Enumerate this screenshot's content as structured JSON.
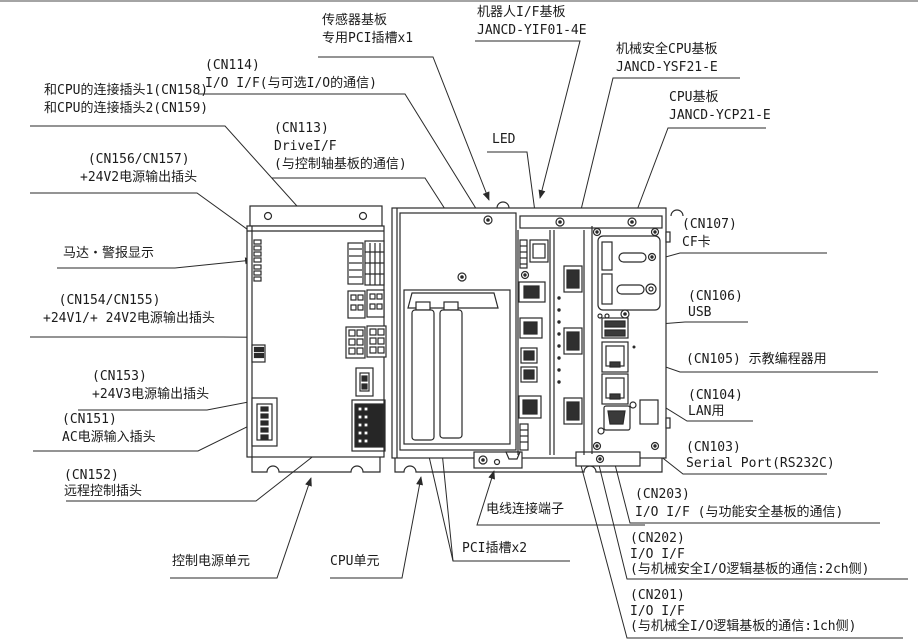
{
  "page": {
    "type": "hardware-connection-diagram"
  },
  "colors": {
    "line": "#2a2a2a",
    "text": "#1b1b1b",
    "background": "#ffffff"
  },
  "labels": {
    "sensor_pci_slot": "传感器基板\n专用PCI插槽x1",
    "robot_if_board": "机器人I/F基板\nJANCD-YIF01-4E",
    "safety_cpu_board": "机械安全CPU基板\nJANCD-YSF21-E",
    "cpu_board": "CPU基板\nJANCD-YCP21-E",
    "cn114": "(CN114)\nI/O I/F(与可选I/O的通信)",
    "led": "LED",
    "cn113": "(CN113)\nDriveI/F\n(与控制轴基板的通信)",
    "cn158_159": "和CPU的连接插头1(CN158)\n和CPU的连接插头2(CN159)",
    "cn156_157": " (CN156/CN157)\n+24V2电源输出插头",
    "motor_alarm_display": "马达・警报显示",
    "cn154_155": "  (CN154/CN155)\n+24V1/+ 24V2电源输出插头",
    "cn153": "(CN153)\n+24V3电源输出插头",
    "cn151": "(CN151)\nAC电源输入插头",
    "cn152": "(CN152)\n远程控制插头",
    "power_unit": "控制电源单元",
    "cpu_unit": "CPU单元",
    "wire_terminal": "电线连接端子",
    "pci_slots": "PCI插槽x2",
    "cn107": "(CN107)\nCF卡",
    "cn106": "(CN106)\nUSB",
    "cn105": "(CN105) 示教编程器用",
    "cn104": "(CN104)\nLAN用",
    "cn103": "(CN103)\nSerial Port(RS232C)",
    "cn203": "(CN203)\nI/O I/F (与功能安全基板的通信)",
    "cn202": "(CN202)\nI/O I/F\n(与机械安全I/O逻辑基板的通信:2ch侧)",
    "cn201": "(CN201)\nI/O I/F\n(与机械全I/O逻辑基板的通信:1ch侧)"
  }
}
